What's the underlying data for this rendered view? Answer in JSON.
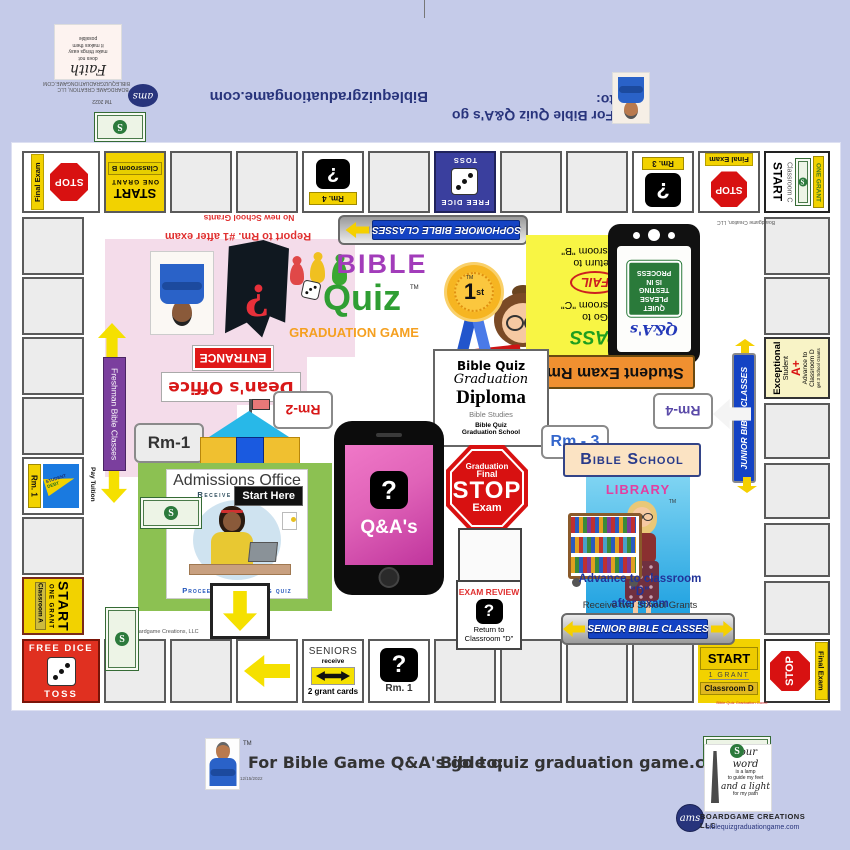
{
  "colors": {
    "background": "#c5cbe9",
    "board": "#ffffff",
    "cell_gray": "#ececec",
    "yellow": "#f2d200",
    "stop_red": "#d81111",
    "banner_blue": "#1443c4",
    "free_dice_blue": "#3a3f9e",
    "free_dice_red": "#e03020",
    "freshman_purple": "#7b3f9e",
    "logo_purple": "#a23cba",
    "logo_green": "#2f9e33",
    "logo_orange": "#f5a020",
    "admissions_green": "#8cc152",
    "library_blue": "#2fa8e6",
    "phone_pink": "#e063b8",
    "exam_banner_orange": "#f09030",
    "exceptional_yellow": "#f8f3c6"
  },
  "top_strip": {
    "faith_title": "Faith",
    "faith_text": "does not\nmake things easy\nit makes them\npossible",
    "maker_line1": "BOARDGAME CREATION, LLC",
    "maker_line2": "BIBLEQUIZGRADUATIONGAME.COM",
    "tm": "TM",
    "year": "2022",
    "ams_logo": "ams",
    "site": "Biblequizgraduationgame.com",
    "promo": "For Bible Quiz Q&A's go to:"
  },
  "board": {
    "credit_top": "Boardgame Creation, LLC",
    "credit_bottom": "Boardgame Creations, LLC",
    "corner_tl": {
      "stop": "STOP",
      "final_exam": "Final Exam"
    },
    "start_b": {
      "start": "START",
      "grant": "ONE GRANT",
      "room": "Classroom B"
    },
    "rm4_cell": {
      "q": "?",
      "room": "Rm. 4"
    },
    "free_dice_top": {
      "title": "FREE DICE",
      "toss": "TOSS"
    },
    "rm3_cell": {
      "q": "?",
      "room": "Rm. 3"
    },
    "final_exam_top": {
      "stop": "STOP",
      "final_exam": "Final Exam"
    },
    "corner_tr": {
      "start": "START",
      "room": "Classroom C",
      "grant": "ONE GRANT"
    },
    "exceptional": {
      "line1": "Exceptional",
      "line2": "Student",
      "grade": "A+",
      "line3": "Advance to",
      "line4": "Classroom D",
      "line5": "get 3 School Grants"
    },
    "rm1_cell": {
      "room": "Rm. 1",
      "pennant_top": "STUDENT",
      "pennant_bottom": "DEBT"
    },
    "start_a": {
      "start": "START",
      "grant": "ONE GRANT",
      "room": "Classroom A"
    },
    "corner_bl": {
      "title": "FREE DICE",
      "toss": "TOSS"
    },
    "seniors": {
      "title": "SENIORS",
      "receive": "receive",
      "cards": "2 grant cards"
    },
    "rm1_bottom": {
      "q": "?",
      "room": "Rm. 1"
    },
    "start_d": {
      "start": "START",
      "grant": "1 GRANT",
      "room": "Classroom D"
    },
    "corner_br": {
      "stop": "STOP",
      "final_exam": "Final Exam"
    }
  },
  "center": {
    "no_grants": "No new School Grants",
    "report": "Report to Rm. #1 after exam",
    "sophomore_banner": "SOPHOMORE BIBLE CLASSES",
    "logo": {
      "bible": "BIBLE",
      "quiz": "Quiz",
      "tm": "TM",
      "subtitle": "GRADUATION  GAME"
    },
    "holy_bible": "HOLY\nBIBLE",
    "entrance": "ENTRANCE",
    "deans_office": "Dean's Office",
    "rm2_bubble": "Rm-2",
    "rm1_bubble": "Rm-1",
    "ribbon": {
      "place": "1",
      "suffix": "st",
      "tm": "TM"
    },
    "pass_fail": {
      "pass": "PASS",
      "pass_dest": "Go to\nClassroom \"C\"",
      "fail": "FAIL",
      "fail_dest": "Return to\nClassroom \"B\""
    },
    "tablet": {
      "qa": "Q&A's",
      "sign": "QUIET\nPLEASE\nTESTING\nIS IN\nPROCESS"
    },
    "exam_room_banner": "Student Exam Rm.",
    "rm4_bubble": "Rm-4",
    "diploma": {
      "line1": "Bible Quiz",
      "line2": "Graduation",
      "line3": "Diploma",
      "line4": "Bible Studies",
      "line5": "Bible Quiz",
      "line6": "Graduation School"
    },
    "rm3_bubble": "Rm - 3",
    "stop_sign": {
      "line1": "Graduation",
      "line2": "Final",
      "stop": "STOP",
      "exam": "Exam"
    },
    "phone": {
      "q": "?",
      "qa": "Q&A's"
    },
    "exam_review": {
      "title": "EXAM REVIEW",
      "q": "?",
      "dest": "Return to\nClassroom  \"D\""
    },
    "library": {
      "school": "Bible School",
      "name": "LIBRARY",
      "tm": "TM",
      "advance": "Advance to classroom \"D\"\nafter exam",
      "receive": "Receive two School Grants"
    },
    "senior_banner": "SENIOR BIBLE CLASSES",
    "junior_banner": "JUNIOR BIBLE CLASSES",
    "freshman_banner": "Freshman Bible Classes",
    "pay_tuition": "Pay Tuition",
    "admissions": {
      "title": "Admissions Office",
      "receive": "Receive 4 Grants",
      "start_here": "Start Here",
      "proceed": "Proceed after passing quiz"
    },
    "bill_s": "S"
  },
  "footer": {
    "tm": "TM",
    "date": "12/15/2022",
    "promo": "For Bible Game Q&A's go to:",
    "site": "Bible quiz graduation game.com",
    "bill_caption": "Bible Quiz Graduation Game",
    "lamp_card": {
      "line1": "Your word",
      "line2": "is a lamp",
      "line3": "to guide my feet",
      "line4": "and a light",
      "line5": "for  my path"
    },
    "ams_logo": "ams",
    "company": "BOARDGAME  CREATIONS  LLC",
    "website": "biblequizgraduationgame.com"
  }
}
